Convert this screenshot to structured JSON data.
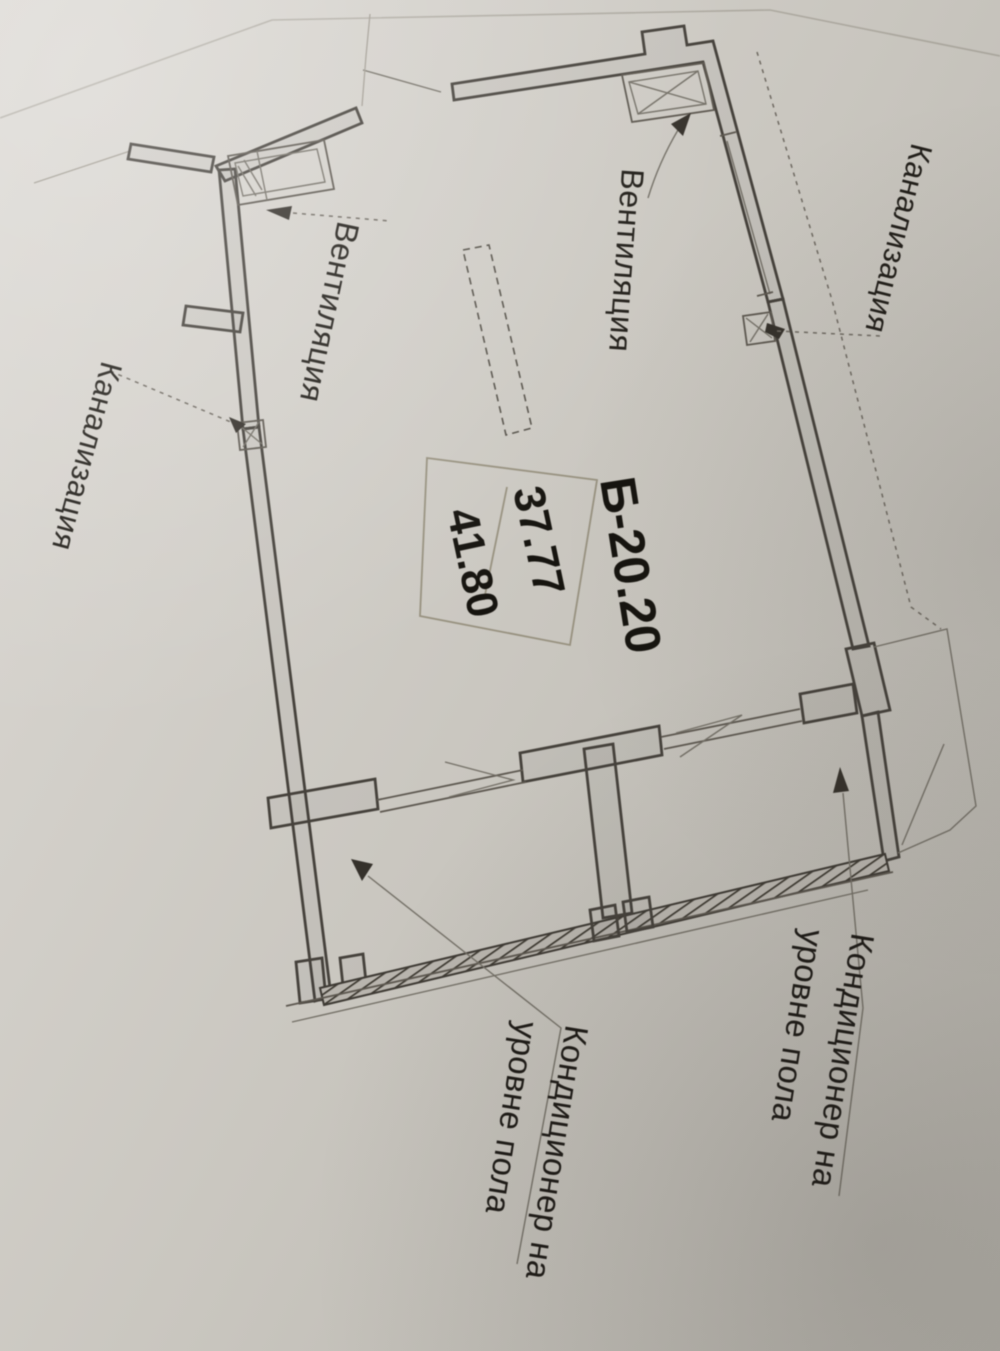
{
  "plan": {
    "stamp": {
      "unit_number": "Б-20.20",
      "living_area": "37.77",
      "total_area": "41.80"
    },
    "labels": {
      "ventilation_left": "Вентиляция",
      "ventilation_right": "Вентиляция",
      "sewerage_left": "Канализация",
      "sewerage_right": "Канализация",
      "ac_bottom_line1": "Кондиционер на",
      "ac_bottom_line2": "уровне пола",
      "ac_right_line1": "Кондиционер на",
      "ac_right_line2": "уровне пола"
    },
    "colors": {
      "paper": "#cfccc6",
      "ink": "#45413b",
      "label_ink": "#211e19"
    }
  }
}
